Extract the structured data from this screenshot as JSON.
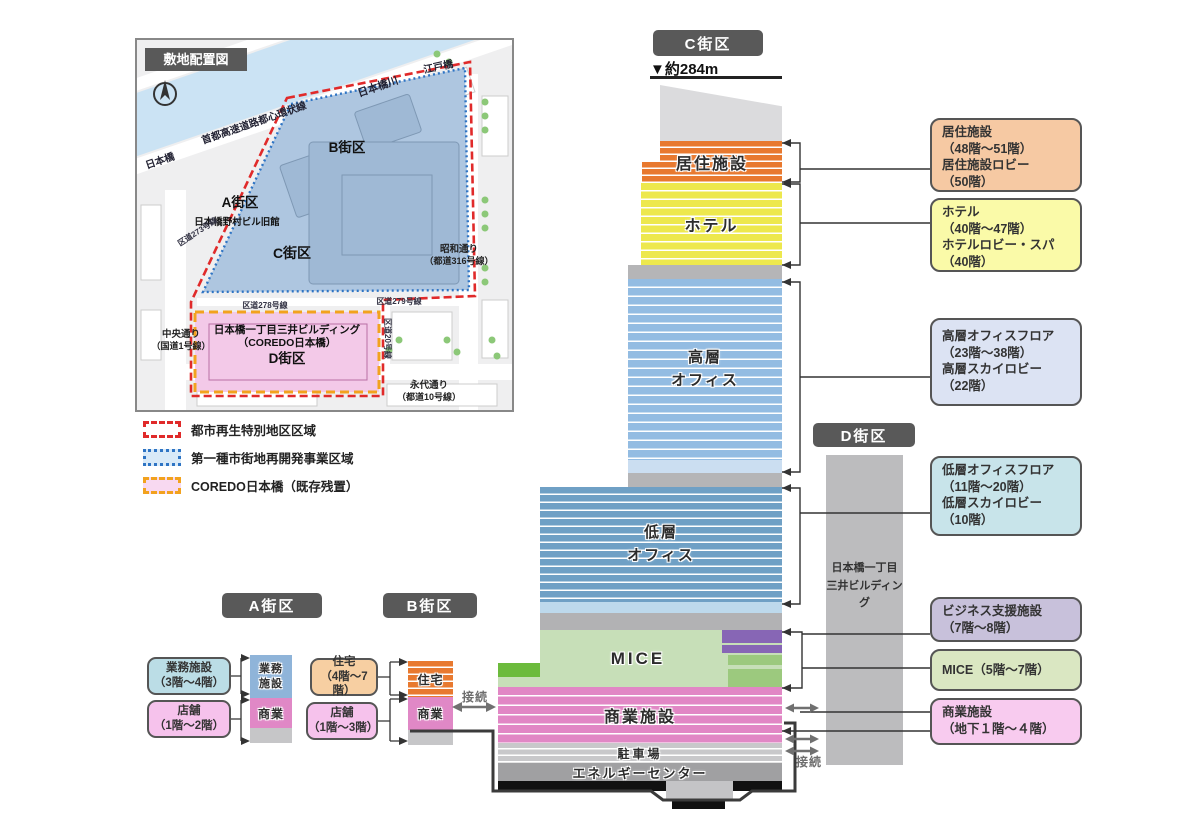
{
  "map": {
    "title": "敷地配置図",
    "labels": {
      "expressway": "首都高速道路都心環状線",
      "river": "日本橋川",
      "edobashi": "江戸橋",
      "nihonbashi": "日本橋",
      "block_a": "A街区",
      "block_b": "B街区",
      "block_c": "C街区",
      "block_d": "D街区",
      "nomura": "日本橋野村ビル旧館",
      "road273": "区道273号線",
      "road278": "区道278号線",
      "road279": "区道279号線",
      "road20": "区道20号線",
      "showa_dori": "昭和通り",
      "showa_dori_sub": "（都道316号線）",
      "chuo_dori": "中央通り",
      "chuo_dori_sub": "（国道1号線）",
      "eitai_dori": "永代通り",
      "eitai_dori_sub": "（都道10号線）",
      "mitsui_line1": "日本橋一丁目三井ビルディング",
      "mitsui_line2": "（COREDO日本橋）"
    }
  },
  "legend": {
    "items": [
      {
        "label": "都市再生特別地区区域",
        "style": "red-dashed"
      },
      {
        "label": "第一種市街地再開発事業区域",
        "style": "blue-dotted"
      },
      {
        "label": "COREDO日本橋（既存残置）",
        "style": "orange-dashed"
      }
    ]
  },
  "tower": {
    "block_label": "C街区",
    "height_label": "▼約284m",
    "sections": {
      "residential": "居住施設",
      "hotel": "ホテル",
      "high_office_l1": "高層",
      "high_office_l2": "オフィス",
      "low_office_l1": "低層",
      "low_office_l2": "オフィス",
      "mice": "MICE",
      "commercial": "商業施設",
      "parking": "駐車場",
      "energy": "エネルギーセンター"
    }
  },
  "d_block": {
    "label": "D街区",
    "building_l1": "日本橋一丁目",
    "building_l2": "三井ビルディング"
  },
  "callouts": {
    "residential": {
      "l1": "居住施設",
      "l2": "（48階～51階）",
      "l3": "居住施設ロビー",
      "l4": "（50階）"
    },
    "hotel": {
      "l1": "ホテル",
      "l2": "（40階～47階）",
      "l3": "ホテルロビー・スパ",
      "l4": "（40階）"
    },
    "high_office": {
      "l1": "高層オフィスフロア",
      "l2": "（23階～38階）",
      "l3": "高層スカイロビー",
      "l4": "（22階）"
    },
    "low_office": {
      "l1": "低層オフィスフロア",
      "l2": "（11階～20階）",
      "l3": "低層スカイロビー",
      "l4": "（10階）"
    },
    "business": {
      "l1": "ビジネス支援施設",
      "l2": "（7階～8階）"
    },
    "mice": {
      "l1": "MICE（5階～7階）"
    },
    "commercial": {
      "l1": "商業施設",
      "l2": "（地下１階～４階）"
    }
  },
  "a_block": {
    "label": "A街区",
    "callout1_l1": "業務施設",
    "callout1_l2": "（3階～4階）",
    "callout2_l1": "店舗",
    "callout2_l2": "（1階～2階）",
    "tower_top_l1": "業務",
    "tower_top_l2": "施設",
    "tower_bottom": "商業"
  },
  "b_block": {
    "label": "B街区",
    "callout1_l1": "住宅",
    "callout1_l2": "（4階～7階）",
    "callout2_l1": "店舗",
    "callout2_l2": "（1階～3階）",
    "tower_top": "住宅",
    "tower_bottom": "商業"
  },
  "connections": {
    "left": "接続",
    "right": "接続"
  },
  "colors": {
    "block_label_bg": "#595959",
    "residential_orange": "#E8792F",
    "hotel_yellow": "#EDE84D",
    "high_office_blue": "#93BCE2",
    "low_office_blue": "#6FA0C5",
    "mice_green": "#C7DFB8",
    "mice_green_medium": "#9CC97E",
    "mice_green_bright": "#6CBB3C",
    "business_purple": "#8766B5",
    "commercial_pink": "#E187C5",
    "parking_gray": "#C8C8CA",
    "energy_gray": "#A0A0A2",
    "d_building_gray": "#BCBCBE",
    "callout_residential": "#F6C9A3",
    "callout_hotel": "#FAFAA8",
    "callout_high_office": "#DCE3F3",
    "callout_low_office": "#C8E4EA",
    "callout_business": "#C8C1DB",
    "callout_mice": "#DAE7C2",
    "callout_commercial": "#F8CBEF",
    "legend_red": "#E02A2A",
    "legend_blue": "#2E74C4",
    "legend_orange": "#F2A21E",
    "site_blue": "#AEC6E0",
    "site_pink": "#F3C9E8",
    "water_blue": "#CBE3F4"
  }
}
